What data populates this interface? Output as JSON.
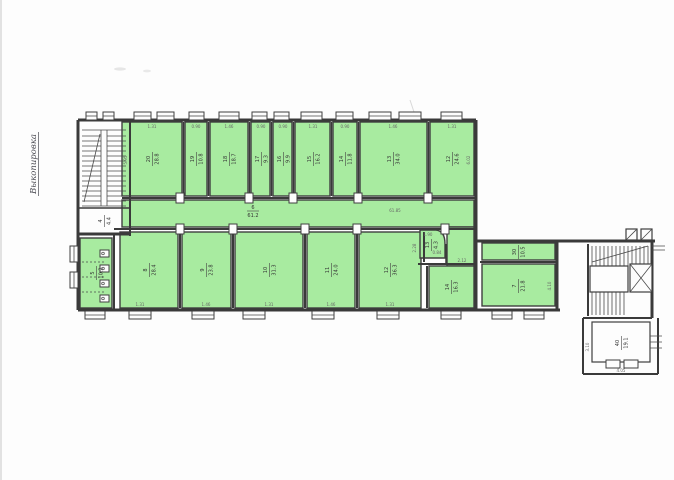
{
  "annotation": {
    "side_note": "Выкопировка"
  },
  "colors": {
    "room_fill": "#a8eba0",
    "line": "#3a3a3a",
    "paper": "#fdfdfd"
  },
  "plan": {
    "rooms": {
      "top": [
        {
          "num": "20",
          "area": "28.8"
        },
        {
          "num": "19",
          "area": "10.8"
        },
        {
          "num": "18",
          "area": "18.7"
        },
        {
          "num": "17",
          "area": "9.3"
        },
        {
          "num": "16",
          "area": "9.9"
        },
        {
          "num": "15",
          "area": "16.2"
        },
        {
          "num": "14",
          "area": "11.8"
        },
        {
          "num": "13",
          "area": "34.0"
        },
        {
          "num": "12",
          "area": "24.6"
        }
      ],
      "bottom": [
        {
          "num": "8",
          "area": "28.4"
        },
        {
          "num": "9",
          "area": "23.8"
        },
        {
          "num": "10",
          "area": "31.3"
        },
        {
          "num": "11",
          "area": "24.0"
        },
        {
          "num": "12",
          "area": "36.3"
        },
        {
          "num": "14",
          "area": "16.3"
        }
      ],
      "corridor": {
        "num": "6",
        "area": "61.2"
      },
      "wc": {
        "num": "5",
        "area": "10.2"
      },
      "understair": {
        "num": "4",
        "area": "4.4"
      },
      "small_diag": {
        "num": "13",
        "area": "4.3"
      },
      "right_top": {
        "num": "30",
        "area": "10.5"
      },
      "right_bottom": {
        "num": "7",
        "area": "21.8"
      },
      "annex": {
        "num": "40",
        "area": "19.1"
      }
    },
    "dims": {
      "corridor_len": "61.85",
      "left_height": "5.95",
      "right_height": "6.02",
      "right_rooms_h": "4.10",
      "diag_a": "1.90",
      "diag_b": "0.84",
      "diag_c": "2.28",
      "pass_w": "2.12",
      "annex_h": "3.10",
      "annex_w": "4.05",
      "top_win": [
        "1.31",
        "0.90",
        "1.46",
        "0.90",
        "0.90",
        "1.31",
        "0.90",
        "1.46",
        "1.31"
      ],
      "bottom_win": [
        "1.31",
        "1.46",
        "1.31",
        "1.46",
        "1.31"
      ]
    }
  }
}
